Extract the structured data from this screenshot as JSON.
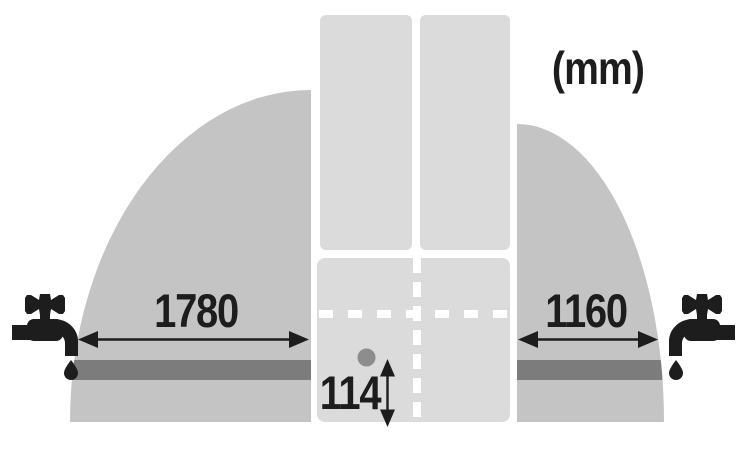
{
  "unit_label": "(mm)",
  "dimensions": {
    "left_reach": "1780",
    "right_reach": "1160",
    "inlet_height": "114"
  },
  "icons": {
    "left_tap": "faucet-icon",
    "right_tap": "faucet-icon"
  },
  "colors": {
    "ink": "#1d1d1d",
    "reach_zone": "#c4c4c4",
    "appliance_panel": "#dbdbdb",
    "supply_bar": "#7c7c7c",
    "inlet_dot": "#8d8d8d",
    "dash": "#ffffff",
    "background": "#ffffff"
  }
}
